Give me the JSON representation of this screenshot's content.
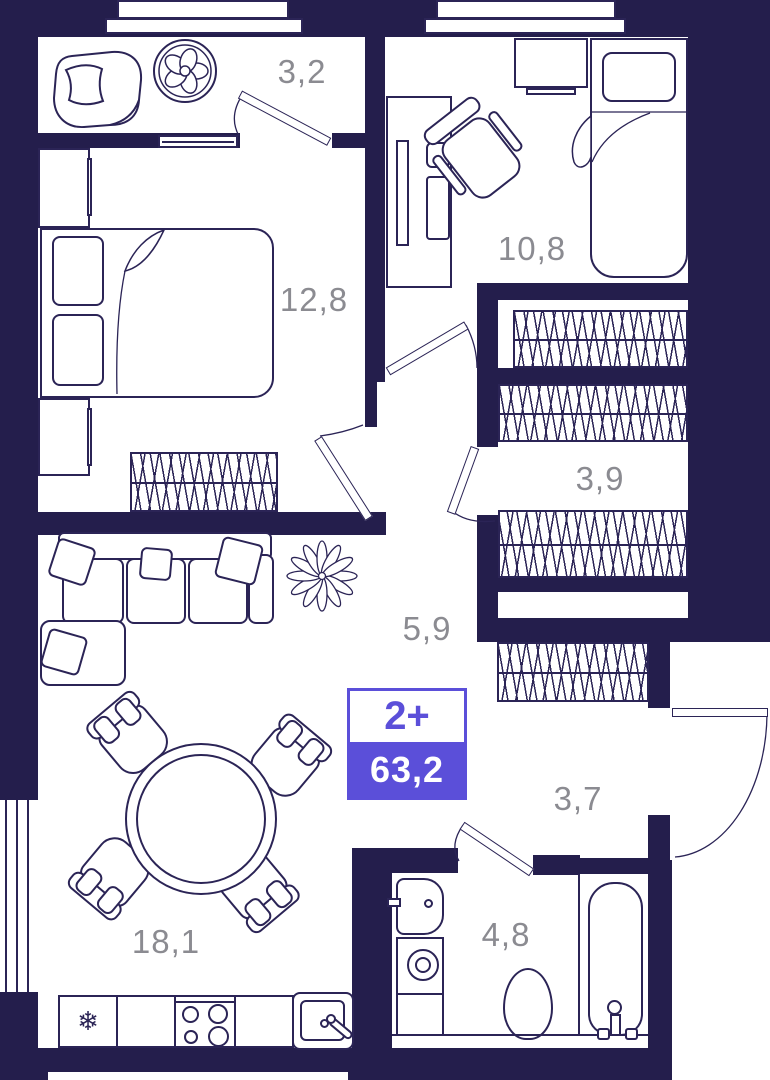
{
  "floor_plan": {
    "badge": {
      "apartment_type": "2+",
      "total_area": "63,2"
    },
    "areas": {
      "loggia": "3,2",
      "bedroom": "12,8",
      "bedroom2": "10,8",
      "wardrobe": "3,9",
      "hallway": "5,9",
      "entry_hall": "3,7",
      "bathroom": "4,8",
      "kitchen_living": "18,1"
    },
    "icons": {
      "fridge": "❄"
    },
    "colors": {
      "wall": "#241e4c",
      "line": "#2b2456",
      "label": "#8b8b91",
      "accent": "#5b4fd9",
      "floor": "#ffffff"
    }
  }
}
